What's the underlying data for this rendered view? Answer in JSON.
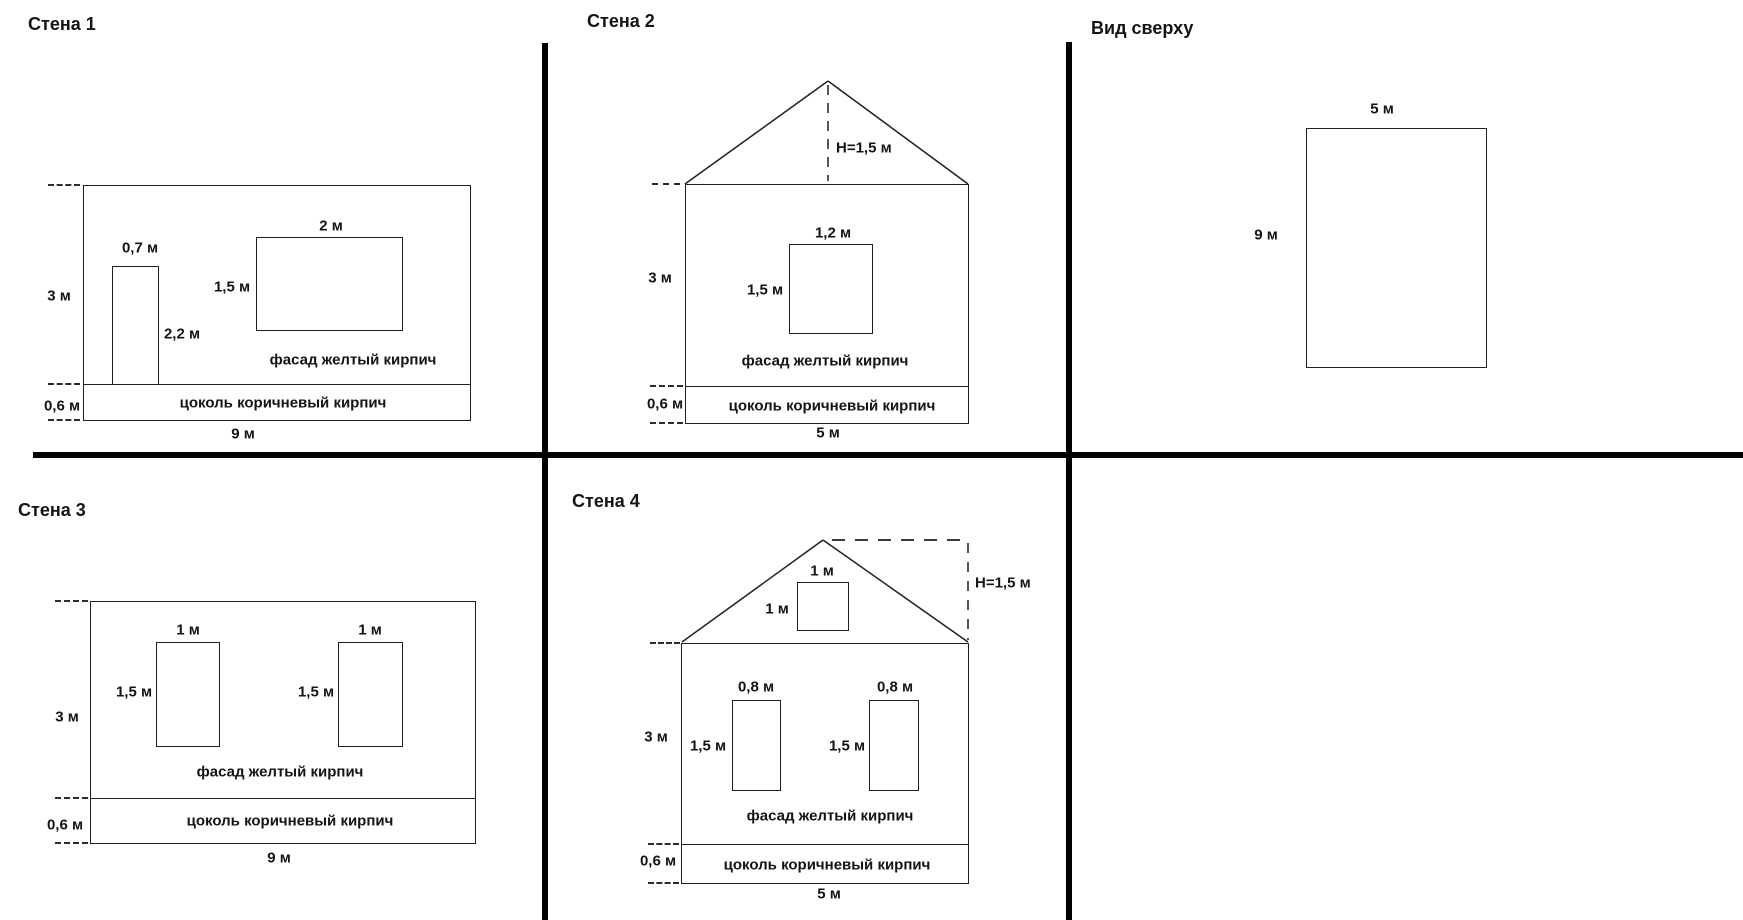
{
  "drawing": {
    "background_color": "#ffffff",
    "line_color": "#1f1f1f",
    "divider_color": "#000000"
  },
  "wall1": {
    "title": "Стена 1",
    "wall_height": "3 м",
    "plinth_height": "0,6 м",
    "wall_width": "9 м",
    "door_width": "0,7 м",
    "door_height": "2,2 м",
    "window_width": "2 м",
    "window_height": "1,5 м",
    "facade_label": "фасад желтый кирпич",
    "plinth_label": "цоколь коричневый кирпич"
  },
  "wall2": {
    "title": "Стена 2",
    "roof_height": "Н=1,5 м",
    "wall_height": "3 м",
    "plinth_height": "0,6 м",
    "wall_width": "5 м",
    "window_width": "1,2 м",
    "window_height": "1,5 м",
    "facade_label": "фасад желтый кирпич",
    "plinth_label": "цоколь коричневый кирпич"
  },
  "top_view": {
    "title": "Вид сверху",
    "width": "5 м",
    "depth": "9 м"
  },
  "wall3": {
    "title": "Стена 3",
    "wall_height": "3 м",
    "plinth_height": "0,6 м",
    "wall_width": "9 м",
    "window1_width": "1 м",
    "window1_height": "1,5 м",
    "window2_width": "1 м",
    "window2_height": "1,5 м",
    "facade_label": "фасад желтый кирпич",
    "plinth_label": "цоколь коричневый кирпич"
  },
  "wall4": {
    "title": "Стена 4",
    "roof_height": "Н=1,5 м",
    "attic_window_width": "1 м",
    "attic_window_height": "1 м",
    "wall_height": "3 м",
    "plinth_height": "0,6 м",
    "wall_width": "5 м",
    "window1_width": "0,8 м",
    "window1_height": "1,5 м",
    "window2_width": "0,8 м",
    "window2_height": "1,5 м",
    "facade_label": "фасад желтый кирпич",
    "plinth_label": "цоколь коричневый кирпич"
  }
}
